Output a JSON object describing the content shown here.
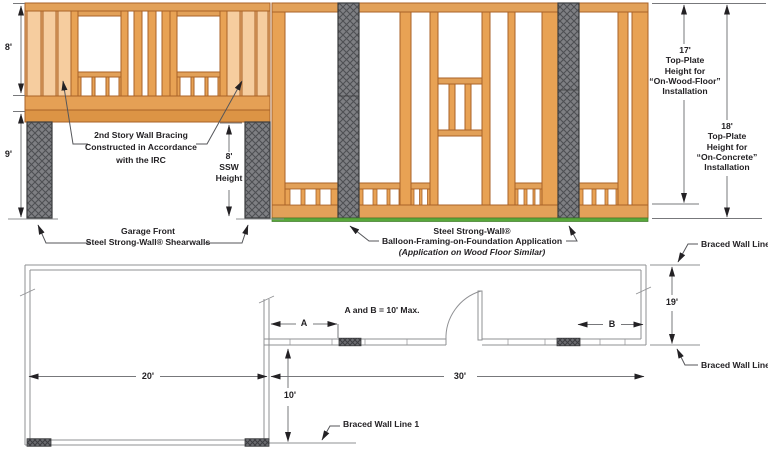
{
  "colors": {
    "wood_light": "#F6CD9F",
    "wood_base": "#EDB377",
    "wood_plate": "#E2A159",
    "wood_stud": "#E8A254",
    "wood_band": "#DC9445",
    "steel_gray": "#7E7F83",
    "hatch_line": "#4E4F53",
    "foundation_green": "#58A83B",
    "line_gray": "#8F9093",
    "text": "#232124"
  },
  "elevation": {
    "dim_story2": "8'",
    "dim_story1": "9'",
    "ssw_height": [
      "8'",
      "SSW",
      "Height"
    ],
    "bracing_note": [
      "2nd Story Wall Bracing",
      "Constructed in Accordance",
      "with the IRC"
    ],
    "garage_label": [
      "Garage Front",
      "Steel Strong-Wall® Shearwalls"
    ],
    "balloon_label": [
      "Steel Strong-Wall®",
      "Balloon-Framing-on-Foundation Application",
      "(Application on Wood Floor Similar)"
    ],
    "wood_floor_dim": [
      "17'",
      "Top-Plate",
      "Height for",
      "“On-Wood-Floor”",
      "Installation"
    ],
    "concrete_dim": [
      "18'",
      "Top-Plate",
      "Height for",
      "“On-Concrete”",
      "Installation"
    ]
  },
  "plan": {
    "braced_wall_line": "Braced Wall Line",
    "braced_wall_line_1": "Braced Wall Line 1",
    "braced_wall_line_2": "Braced Wall Line 2",
    "ab_note": "A and B = 10' Max.",
    "dim_a": "A",
    "dim_b": "B",
    "dim_left_width": "20'",
    "dim_right_width": "30'",
    "dim_left_depth": "10'",
    "dim_right_depth": "19'"
  }
}
